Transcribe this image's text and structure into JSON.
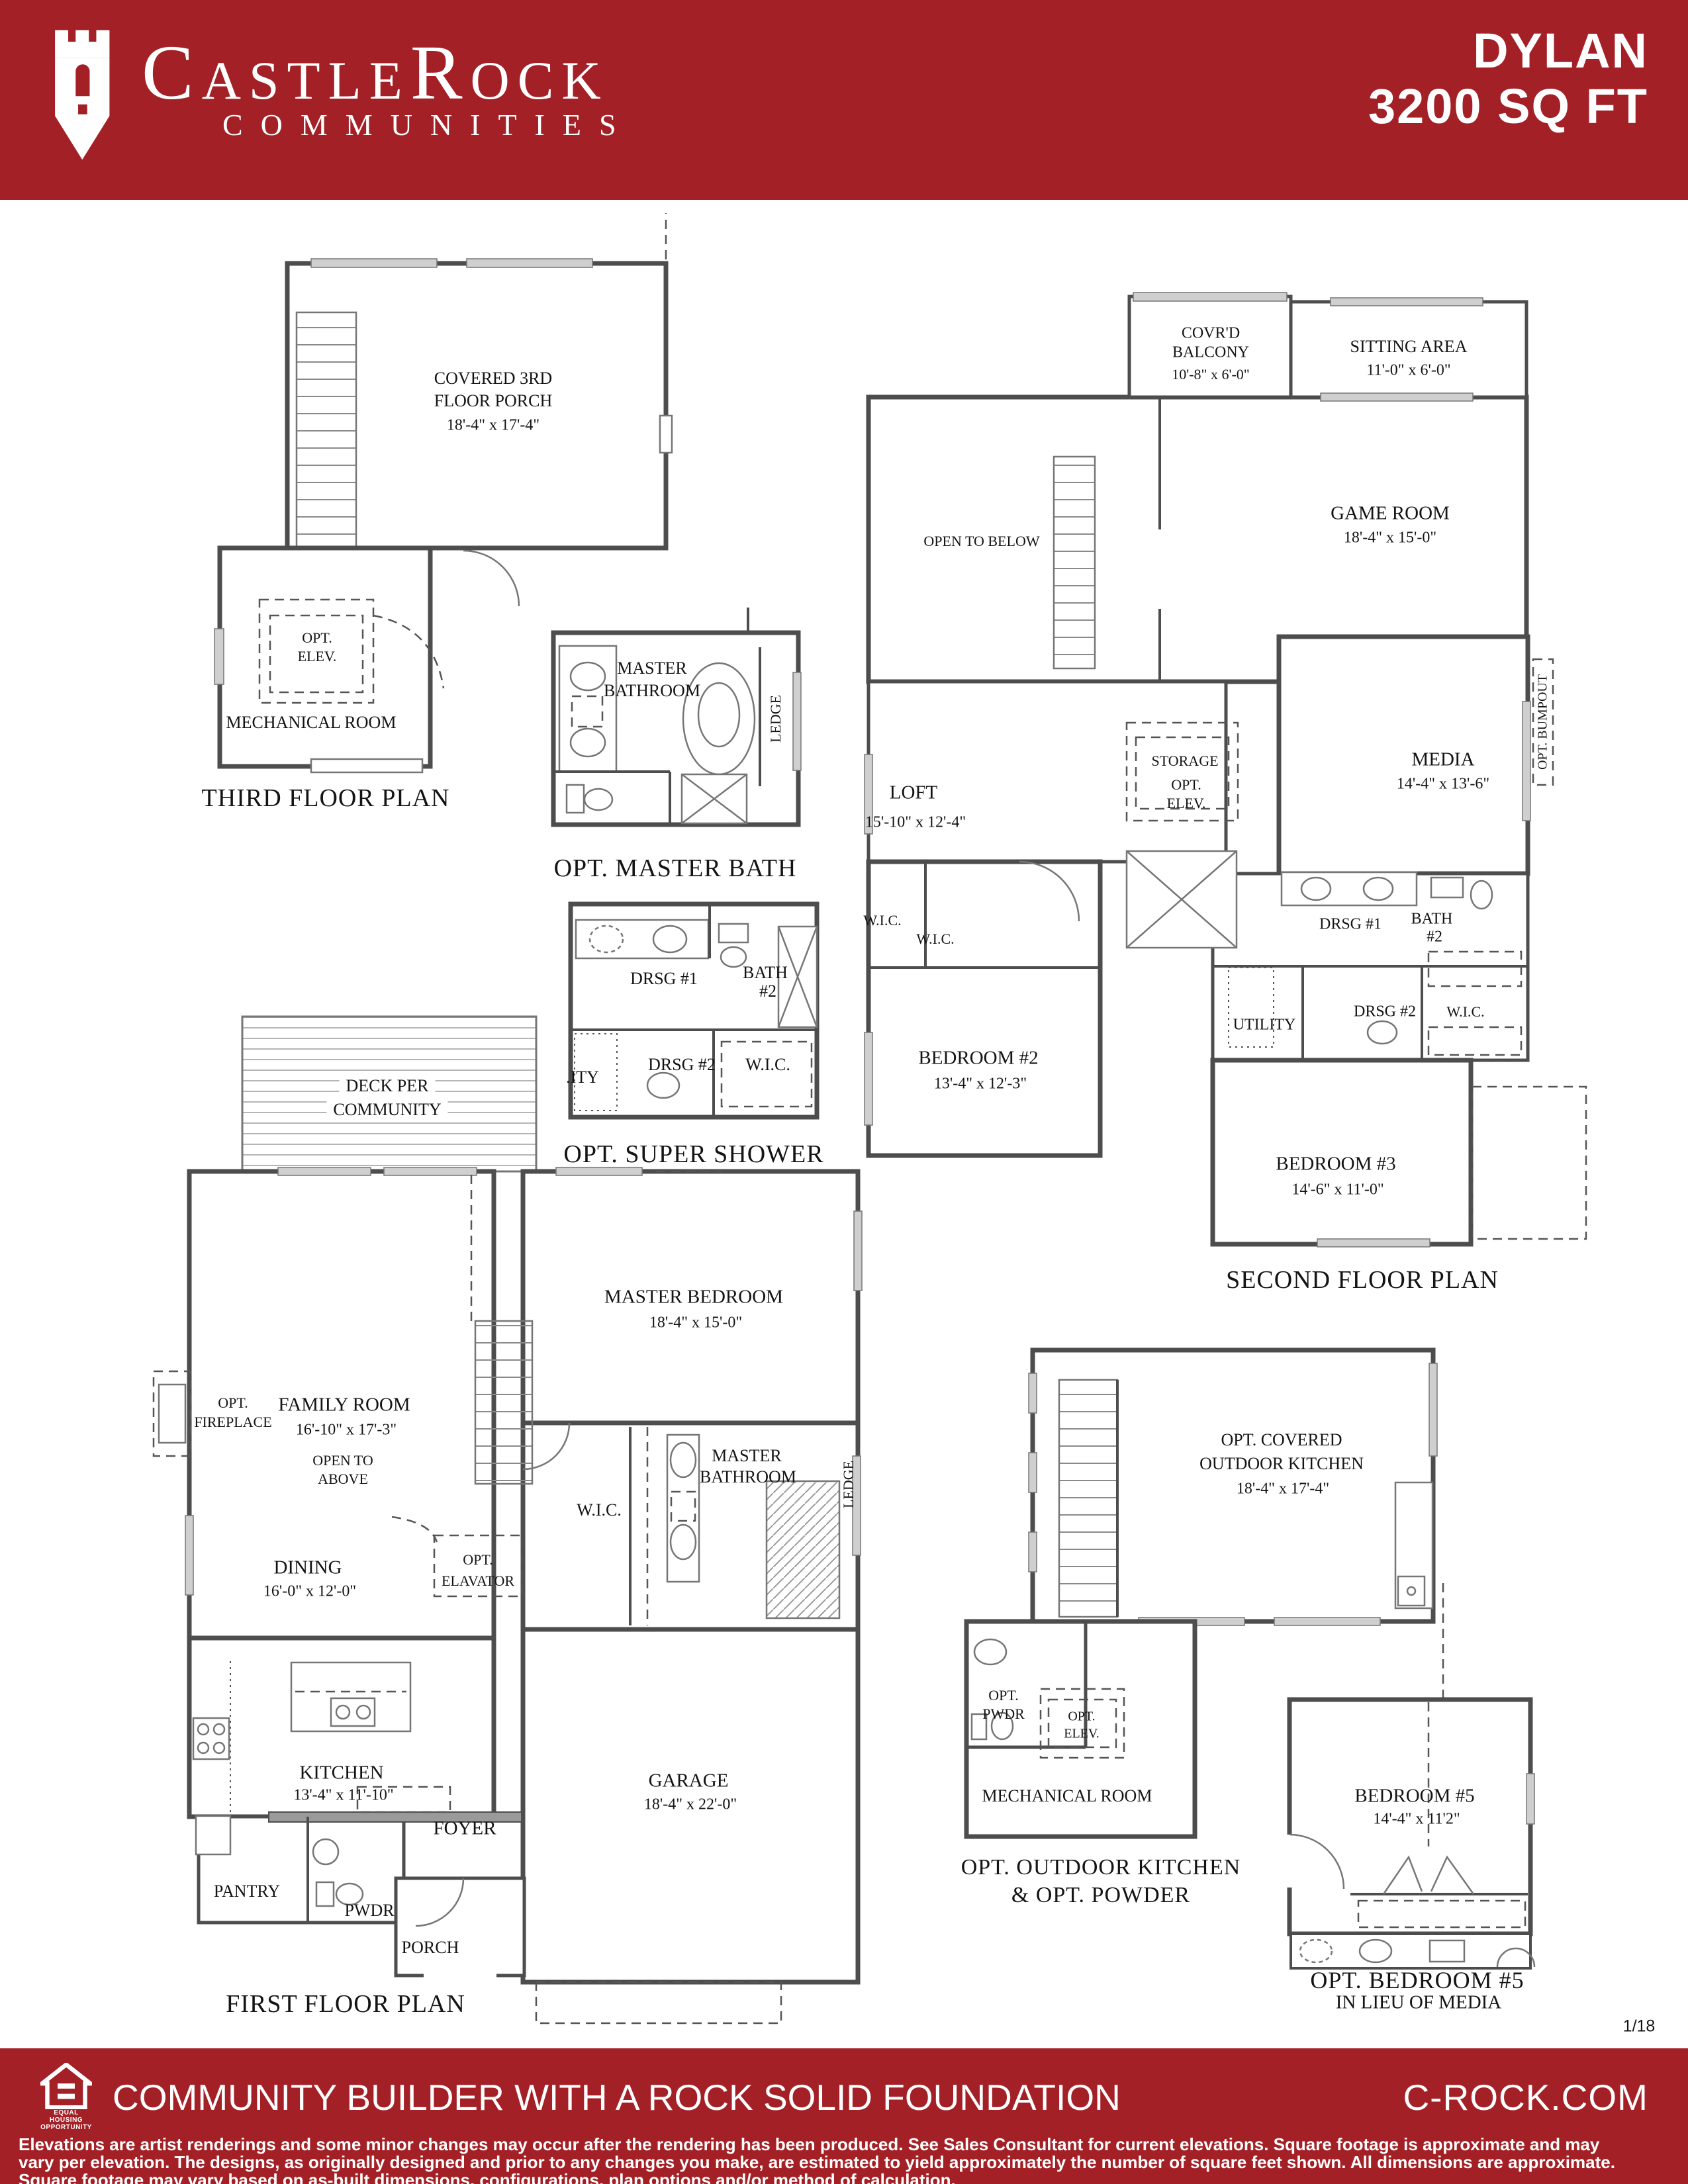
{
  "header": {
    "brand_word1": "CASTLE",
    "brand_word2": "ROCK",
    "brand_sub": "COMMUNITIES",
    "plan_name": "DYLAN",
    "plan_sqft": "3200 SQ FT"
  },
  "colors": {
    "brand_red": "#A32126",
    "wall_gray": "#4d4d4d",
    "ink": "#141414"
  },
  "page": {
    "number": "1/18"
  },
  "footer": {
    "headline": "COMMUNITY BUILDER WITH A ROCK SOLID FOUNDATION",
    "website": "C-ROCK.COM",
    "equal_housing_l1": "EQUAL HOUSING",
    "equal_housing_l2": "OPPORTUNITY",
    "disclaimer_l1": "Elevations are artist renderings and some minor changes may occur after the rendering has been produced. See Sales Consultant for current elevations. Square footage is approximate and may",
    "disclaimer_l2": "vary per elevation. The designs, as originally designed and prior to any changes you make, are estimated to yield approximately the number of square feet shown. All dimensions are approximate.",
    "disclaimer_l3": "Square footage may vary based on as-built dimensions, configurations, plan options and/or method of calculation."
  },
  "plans": {
    "third_floor": {
      "title": "THIRD FLOOR PLAN",
      "covered_porch_l1": "COVERED 3RD",
      "covered_porch_l2": "FLOOR PORCH",
      "covered_porch_dims": "18'-4\" x 17'-4\"",
      "opt_elev_l1": "OPT.",
      "opt_elev_l2": "ELEV.",
      "mechanical_room": "MECHANICAL ROOM"
    },
    "opt_master_bath": {
      "title": "OPT. MASTER BATH",
      "master_bathroom_l1": "MASTER",
      "master_bathroom_l2": "BATHROOM",
      "ledge": "LEDGE"
    },
    "second_floor": {
      "title": "SECOND FLOOR PLAN",
      "covrd_balcony_l1": "COVR'D",
      "covrd_balcony_l2": "BALCONY",
      "covrd_balcony_dims": "10'-8\" x 6'-0\"",
      "sitting_area": "SITTING AREA",
      "sitting_area_dims": "11'-0\" x 6'-0\"",
      "open_to_below": "OPEN TO BELOW",
      "game_room": "GAME ROOM",
      "game_room_dims": "18'-4\" x 15'-0\"",
      "media": "MEDIA",
      "media_dims": "14'-4\" x 13'-6\"",
      "opt_bumpout": "OPT. BUMPOUT",
      "loft": "LOFT",
      "loft_dims": "15'-10\" x 12'-4\"",
      "storage": "STORAGE",
      "storage_opt": "OPT.",
      "storage_elev": "ELEV.",
      "wic_a": "W.I.C.",
      "wic_b": "W.I.C.",
      "drsg1": "DRSG #1",
      "bath2_l1": "BATH",
      "bath2_l2": "#2",
      "utility": "UTILITY",
      "drsg2": "DRSG #2",
      "wic_c": "W.I.C.",
      "bedroom2": "BEDROOM #2",
      "bedroom2_dims": "13'-4\" x 12'-3\"",
      "bedroom3": "BEDROOM #3",
      "bedroom3_dims": "14'-6\" x 11'-0\""
    },
    "opt_super_shower": {
      "title": "OPT. SUPER SHOWER",
      "drsg1": "DRSG #1",
      "bath2_l1": "BATH",
      "bath2_l2": "#2",
      "utility_partial": ".ITY",
      "drsg2": "DRSG #2",
      "wic": "W.I.C."
    },
    "first_floor": {
      "title": "FIRST FLOOR PLAN",
      "deck_l1": "DECK PER",
      "deck_l2": "COMMUNITY",
      "opt_fireplace_l1": "OPT.",
      "opt_fireplace_l2": "FIREPLACE",
      "family_room": "FAMILY ROOM",
      "family_room_dims": "16'-10\" x 17'-3\"",
      "open_to_above_l1": "OPEN TO",
      "open_to_above_l2": "ABOVE",
      "master_bedroom": "MASTER BEDROOM",
      "master_bedroom_dims": "18'-4\" x 15'-0\"",
      "master_bathroom_l1": "MASTER",
      "master_bathroom_l2": "BATHROOM",
      "wic": "W.I.C.",
      "ledge": "LEDGE",
      "dining": "DINING",
      "dining_dims": "16'-0\" x 12'-0\"",
      "opt_elevator_l1": "OPT.",
      "opt_elevator_l2": "ELAVATOR",
      "kitchen": "KITCHEN",
      "kitchen_dims": "13'-4\" x 11'-10\"",
      "foyer": "FOYER",
      "pantry": "PANTRY",
      "pwdr": "PWDR",
      "porch": "PORCH",
      "garage": "GARAGE",
      "garage_dims": "18'-4\" x 22'-0\""
    },
    "opt_outdoor_kitchen": {
      "title_l1": "OPT. OUTDOOR KITCHEN",
      "title_l2": "& OPT. POWDER",
      "header_l1": "OPT. COVERED",
      "header_l2": "OUTDOOR KITCHEN",
      "header_dims": "18'-4\" x 17'-4\"",
      "opt_pwdr_l1": "OPT.",
      "opt_pwdr_l2": "PWDR",
      "opt_elev_l1": "OPT.",
      "opt_elev_l2": "ELEV.",
      "mechanical_room": "MECHANICAL ROOM"
    },
    "opt_bedroom5": {
      "title_l1": "OPT. BEDROOM #5",
      "title_l2": "IN LIEU OF MEDIA",
      "bedroom5": "BEDROOM #5",
      "bedroom5_dims": "14'-4\" x 11'2\""
    }
  }
}
